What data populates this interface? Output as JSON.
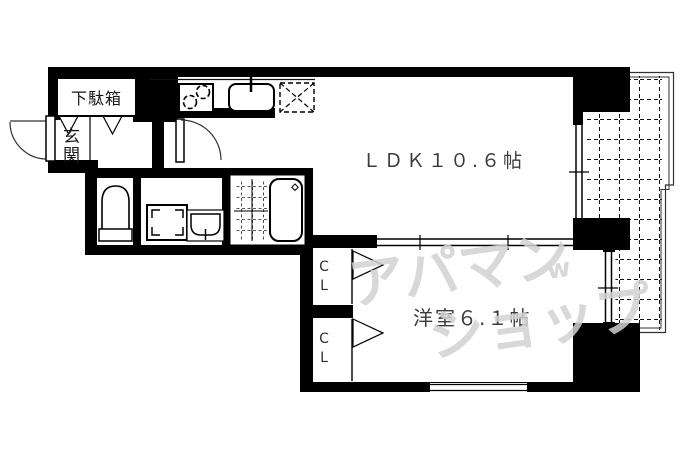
{
  "plan": {
    "type": "floor-plan",
    "background": "#ffffff",
    "wall_color": "#000000",
    "line_color": "#111111",
    "labels": {
      "shoe_cabinet": "下駄箱",
      "entrance": "玄関",
      "ldk": "ＬＤＫ１０.６帖",
      "western_room": "洋室６.１帖",
      "closet_upper": "CL",
      "closet_lower": "CL"
    },
    "watermark": {
      "line1": "アパマン",
      "line2": "ショップ",
      "mark": "w",
      "color": "#d2d2d2"
    },
    "icons": {
      "entrance_door": "swing-door-arc",
      "ldk_door": "swing-door-arc",
      "stove": "two-burner-stove-icon",
      "sink": "kitchen-sink-icon",
      "refrigerator_space": "dashed-square-x-icon",
      "toilet": "toilet-icon",
      "washing_machine": "washing-machine-space-icon",
      "washbasin": "washbasin-icon",
      "bathtub": "bathtub-icon",
      "bathroom_floor": "tiled-floor-pattern",
      "balcony": "tiled-balcony-pattern",
      "closet_doors": "folding-door-triangle-icons",
      "shoe_cabinet_doors": "swing-door-triangle-icons",
      "partition_ldk_western": "sliding-door-double-line",
      "windows": "double-line-window"
    }
  }
}
